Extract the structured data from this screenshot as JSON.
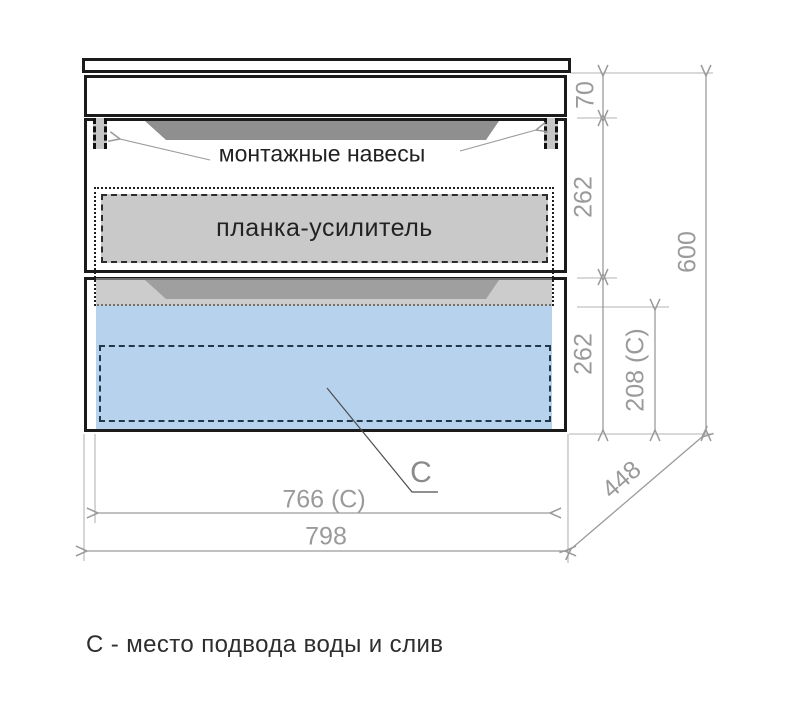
{
  "caption": "С - место подвода воды и слив",
  "labels": {
    "mounting_hangers": "монтажные навесы",
    "reinforcement_bar": "планка-усилитель",
    "connection_marker": "C"
  },
  "dimensions": {
    "apron_height": "70",
    "drawer_top_height": "262",
    "drawer_bottom_height": "262",
    "total_height": "600",
    "connection_height": "208 (C)",
    "connection_width": "766 (C)",
    "total_width": "798",
    "depth": "448"
  },
  "colors": {
    "outline": "#1b1b1b",
    "dimension_line": "#9a9a9a",
    "handle_recess": "#8f8f8f",
    "reinforcement_fill": "#c9c9c9",
    "water_zone_fill": "#b6d2ec"
  }
}
